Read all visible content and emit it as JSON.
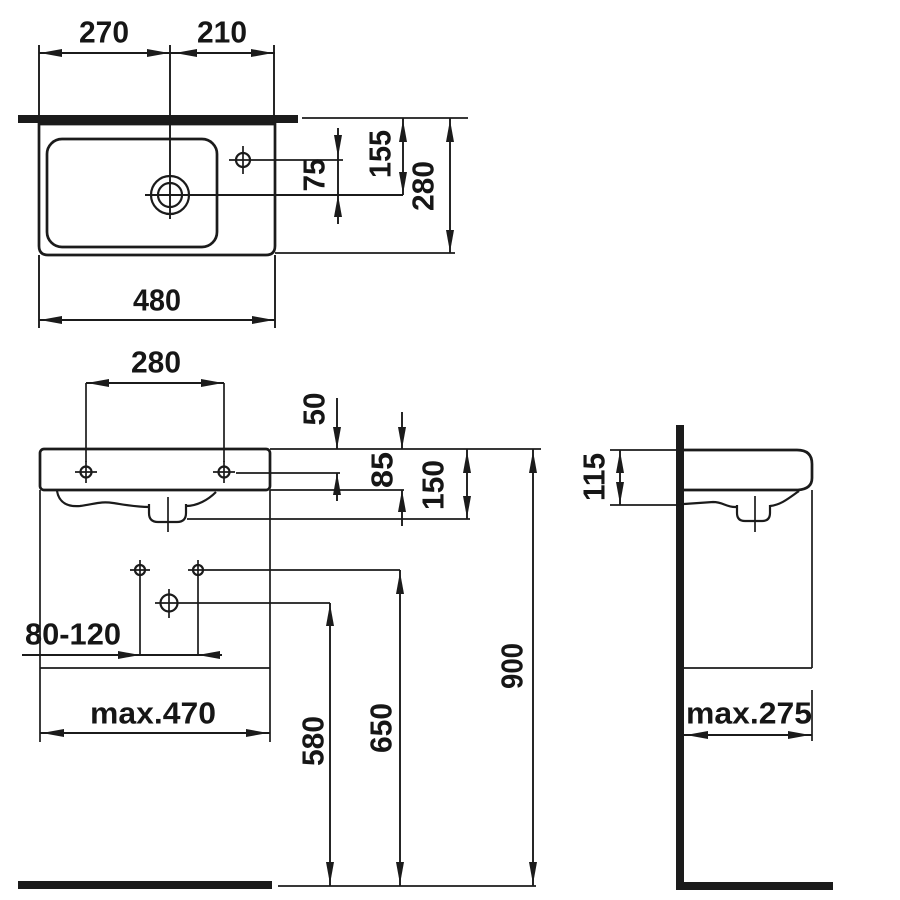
{
  "drawing_type": "washbasin technical dimension drawing",
  "units_note": "",
  "colors": {
    "line": "#1b1b1b",
    "background": "#ffffff"
  },
  "top_view": {
    "left_to_drain": "270",
    "drain_to_right": "210",
    "tap_to_drain": "75",
    "wall_to_drain": "155",
    "overall_depth": "280",
    "overall_width": "480"
  },
  "front_view": {
    "hole_spacing": "280",
    "rim_to_holes": "50",
    "body_height": "85",
    "rim_to_outlet": "150",
    "fixing_range": "80-120",
    "max_width": "max.470",
    "outlet_height": "580",
    "fixing_height": "650",
    "rim_height": "900"
  },
  "side_view": {
    "rim_to_underside": "115",
    "max_depth": "max.275"
  }
}
